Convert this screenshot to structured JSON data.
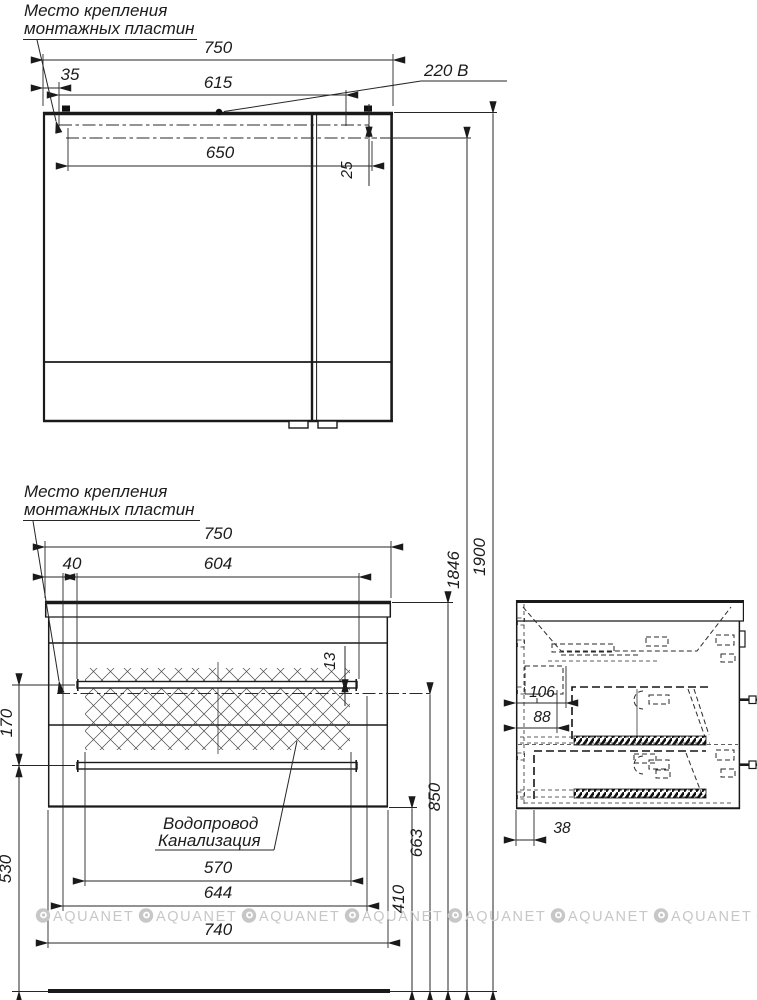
{
  "drawing": {
    "mount_label_line1": "Место крепления",
    "mount_label_line2": "монтажных пластин",
    "power_label": "220 В",
    "water_label_line1": "Водопровод",
    "water_label_line2": "Канализация",
    "watermark": "AQUANET"
  },
  "dims": {
    "mirror": {
      "width": "750",
      "plate_offset": "35",
      "outlet_span": "615",
      "holes_span": "650",
      "top_drop": "25"
    },
    "vanity": {
      "width": "750",
      "plate_offset": "40",
      "rail_span": "604",
      "rail_drop": "13",
      "basin_span": "570",
      "plate_span": "644",
      "body_width": "740"
    },
    "heights": {
      "total": "1900",
      "mount": "1846",
      "counter": "850",
      "rail": "663",
      "rail_floor": "530",
      "bottom": "410",
      "rail_gap": "170"
    },
    "side": {
      "d1": "106",
      "d2": "88",
      "d3": "38"
    }
  }
}
